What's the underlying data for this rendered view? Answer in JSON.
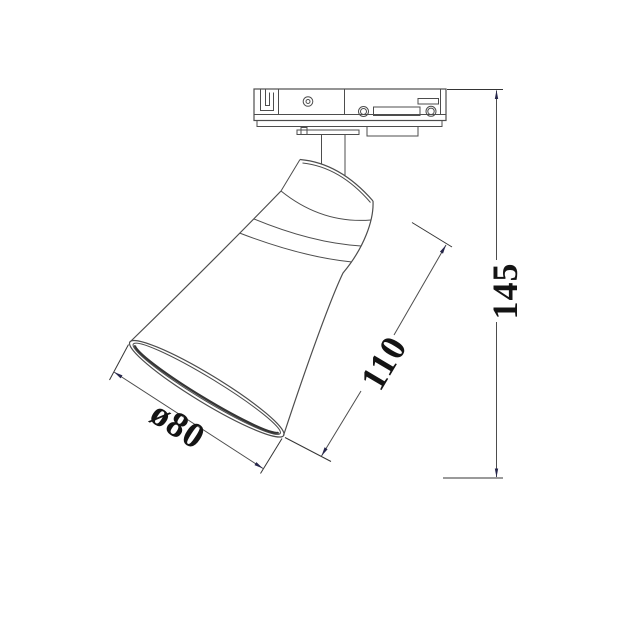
{
  "drawing": {
    "type": "technical-dimension-drawing",
    "subject": "track-mounted spotlight with conical shade",
    "labels": {
      "height": "145",
      "length": "110",
      "diameter": "ø80"
    },
    "colors": {
      "line": "#4d4d4d",
      "darkline": "#353535",
      "arrow": "#26264a",
      "text": "#141414",
      "bg": "#ffffff"
    }
  }
}
